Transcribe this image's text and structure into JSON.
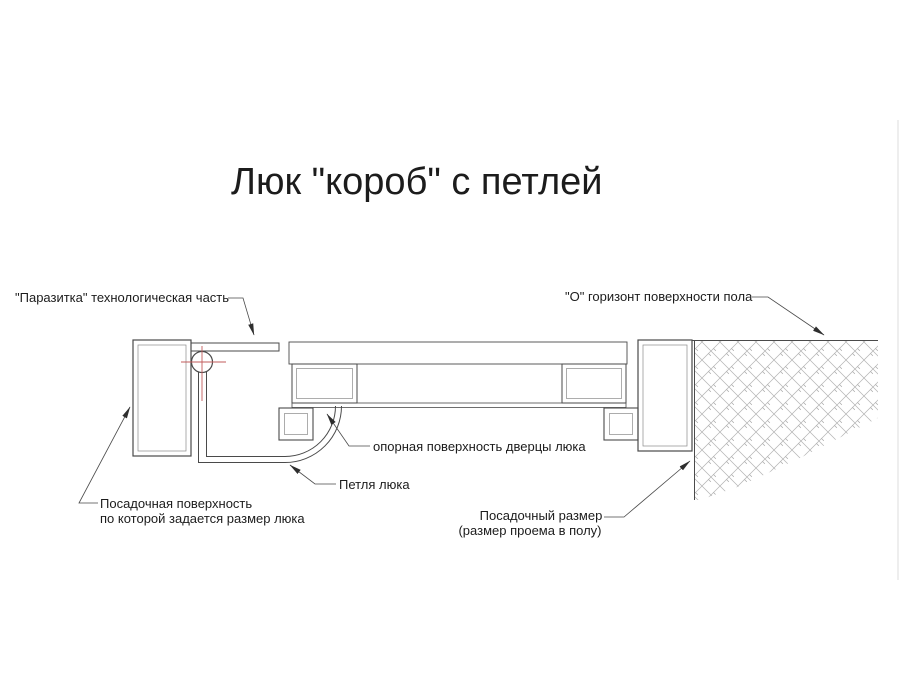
{
  "title": "Люк \"короб\" с петлей",
  "labels": {
    "parasitka": "\"Паразитка\" технологическая часть",
    "floor_horizon": "\"О\" горизонт поверхности пола",
    "door_support_surface": "опорная поверхность дверцы люка",
    "hinge": "Петля люка",
    "seat_surface_line1": "Посадочная поверхность",
    "seat_surface_line2": "по которой задается размер люка",
    "seat_size_line1": "Посадочный размер",
    "seat_size_line2": "(размер проема в полу)"
  },
  "colors": {
    "line": "#4a4a4a",
    "hatch": "#adadad",
    "center_mark": "#c25b5b",
    "text": "#1c1c1c",
    "background": "#ffffff"
  }
}
